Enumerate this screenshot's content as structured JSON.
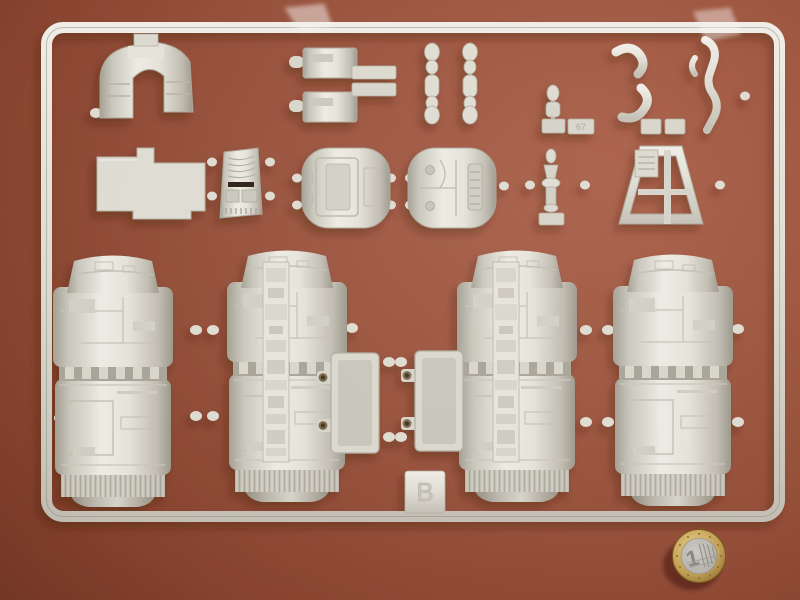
{
  "scene": {
    "description": "Photograph of a light grey injection-moulded model kit sprue (runner B) holding four large cylindrical engine half-shells and many small detail parts, lying on a reddish-brown tabletop with a 1 euro coin for scale",
    "background": {
      "surface": "brown tabletop",
      "color_dark": "#6a301e",
      "color_light": "#aa6049"
    }
  },
  "sprue": {
    "plastic_color": "#dcd9cf",
    "shadow_color": "#3a1a10",
    "markings": {
      "gate_letter": "B",
      "part_number_tab": "67"
    },
    "parts": [
      {
        "name": "arch-bracket",
        "note": "arched mounting bracket with moulded detail blocks"
      },
      {
        "name": "equipment-box-pair",
        "note": "two small rectangular boxes with cylindrical nubs"
      },
      {
        "name": "flat-tab-plates",
        "note": "two thin flat rectangular plates on the runner"
      },
      {
        "name": "linkage-chain-left",
        "note": "segmented linkage strip with ball joints"
      },
      {
        "name": "linkage-chain-right",
        "note": "segmented linkage strip with ball joints"
      },
      {
        "name": "valve-dumbbell",
        "note": "small valve part above a number tab"
      },
      {
        "name": "hook-tubes",
        "note": "two curved hook-shaped tube pieces"
      },
      {
        "name": "hose-part",
        "note": "articulated hose / figure-like piece"
      },
      {
        "name": "l-shaped-plate",
        "note": "flat L-shaped panel"
      },
      {
        "name": "grille-console",
        "note": "curved console with grille lines and dark slot"
      },
      {
        "name": "hatch-plate",
        "note": "rounded hull plate with hatch door detail"
      },
      {
        "name": "piping-plate",
        "note": "rounded hull plate with piping and rivet detail"
      },
      {
        "name": "turbine-stack",
        "note": "small turbine / valve stack"
      },
      {
        "name": "trapezoid-frame",
        "note": "trapezoidal support frame with centre spar"
      },
      {
        "name": "engine-cylinder-1",
        "note": "large cylindrical engine half-shell, panelled, ribbed skirt"
      },
      {
        "name": "engine-cylinder-2",
        "note": "large cylindrical engine half-shell with greebled spine"
      },
      {
        "name": "engine-cylinder-3",
        "note": "large cylindrical engine half-shell with greebled spine"
      },
      {
        "name": "engine-cylinder-4",
        "note": "large cylindrical engine half-shell, panelled, ribbed skirt"
      },
      {
        "name": "mounting-tray-left",
        "note": "rectangular mounting tray with two drilled pegs"
      },
      {
        "name": "mounting-tray-right",
        "note": "rectangular mounting tray with two drilled pegs"
      }
    ]
  },
  "coin": {
    "value": "1",
    "type": "1 euro coin",
    "ring_color": "#c2a055",
    "center_color": "#b5b3ab"
  },
  "film": {
    "note": "two translucent plastic film fragments under the top rail",
    "count": 2
  }
}
